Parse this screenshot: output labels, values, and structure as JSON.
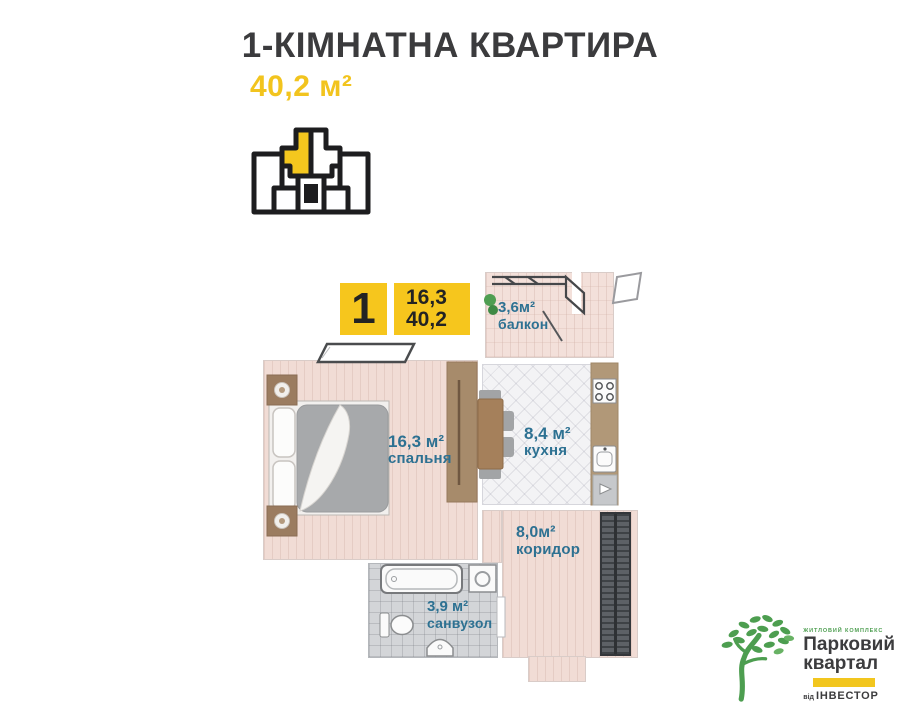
{
  "header": {
    "title": "1-КІМНАТНА КВАРТИРА",
    "total_area": "40,2 м²"
  },
  "unit_badges": {
    "rooms_count": "1",
    "living_area": "16,3",
    "total_area": "40,2"
  },
  "rooms": {
    "balcony": {
      "area": "3,6м²",
      "label": "балкон"
    },
    "bedroom": {
      "area": "16,3 м²",
      "label": "спальня"
    },
    "kitchen": {
      "area": "8,4 м²",
      "label": "кухня"
    },
    "corridor": {
      "area": "8,0м²",
      "label": "коридор"
    },
    "bathroom": {
      "area": "3,9 м²",
      "label": "санвузол"
    }
  },
  "logo": {
    "tagline": "ЖИТЛОВИЙ КОМПЛЕКС",
    "brand_line1": "Парковий",
    "brand_line2": "квартал",
    "developer_prefix": "від",
    "developer": "ІНВЕСТОР"
  },
  "colors": {
    "accent_yellow": "#f4c71e",
    "title_dark": "#3b3b3d",
    "room_label_blue": "#2d7192",
    "logo_green": "#4d9e50",
    "locator_highlight": "#f4c71e"
  }
}
